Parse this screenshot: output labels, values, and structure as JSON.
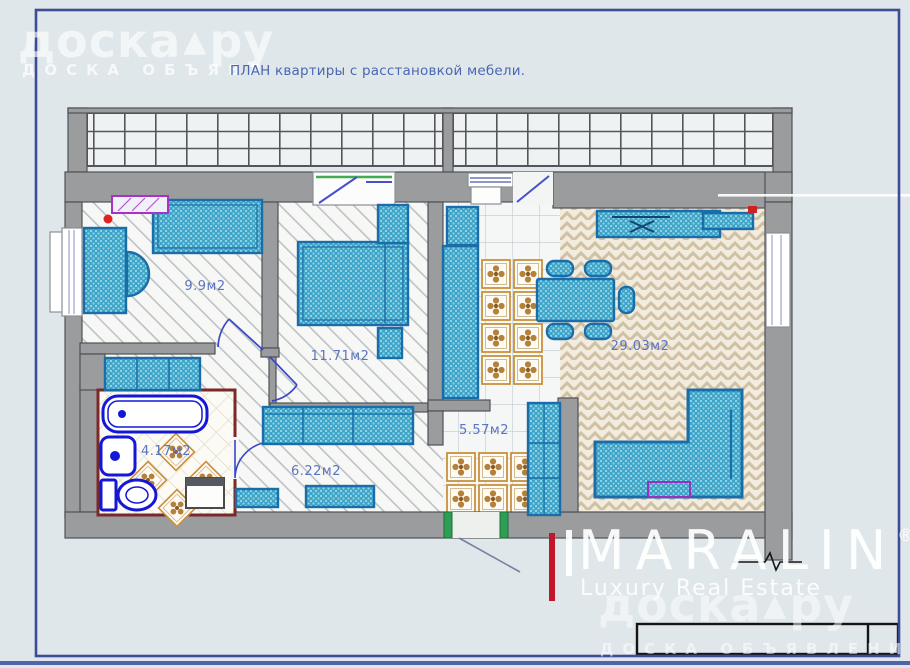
{
  "page": {
    "title": "ПЛАН квартиры с расстановкой мебели."
  },
  "watermarks": {
    "logo_text": "доска",
    "logo_mark": "▲",
    "logo_text2": "ру",
    "doska_sub_top": "ДОСКА ОБЪЯВЛ",
    "doska_sub_bottom": "ДОСКА ОБЪЯВЛЕНИЙ",
    "maralin": "MARALIN",
    "maralin_reg": "®",
    "maralin_tagline": "Luxury Real Estate"
  },
  "plan": {
    "rooms": [
      {
        "name": "bedroom-small",
        "area_label": "9.9м2"
      },
      {
        "name": "bedroom",
        "area_label": "11.71м2"
      },
      {
        "name": "living-room",
        "area_label": "29.03м2"
      },
      {
        "name": "bathroom",
        "area_label": "4.17м2"
      },
      {
        "name": "hallway",
        "area_label": "6.22м2"
      },
      {
        "name": "corridor",
        "area_label": "5.57м2"
      }
    ]
  },
  "colors": {
    "furniture_accent": "#3da3c7",
    "walls": "#9a9c9e",
    "bath_fixtures": "#1418d6",
    "bath_wall_outline": "#7b2828",
    "page_frame": "#3d4c94",
    "red_mark": "#c2172a",
    "room_label": "#5a73c2",
    "decor_tile": "#b5813a",
    "door_jamb_green": "#2f9e55"
  }
}
